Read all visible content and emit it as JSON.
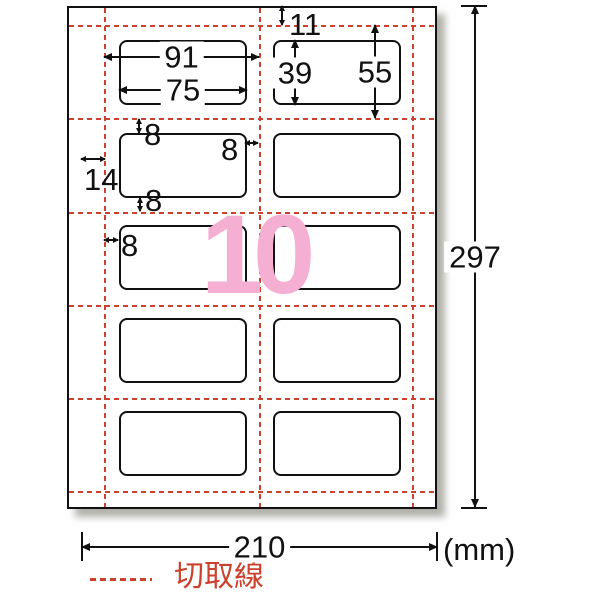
{
  "figure": {
    "watermark_count": "10",
    "unit_label": "(mm)",
    "legend": {
      "cut_line_label": "切取線"
    },
    "dimensions": {
      "sheet_width_mm": "210",
      "sheet_height_mm": "297",
      "top_margin_mm": "11",
      "side_margin_mm": "14",
      "column_pitch_mm": "91",
      "label_width_mm": "75",
      "label_height_mm": "39",
      "row_pitch_mm": "55",
      "gap_above_label_mm": "8",
      "gap_right_of_label_mm": "8",
      "gap_below_label_mm": "8",
      "gap_left_of_label_mm": "8"
    },
    "grid": {
      "rows": 5,
      "columns": 2,
      "label_count": 10
    },
    "colors": {
      "cut_line_red": "#cc402e",
      "watermark_pink": "#f5afd2",
      "line_black": "#111111"
    }
  }
}
